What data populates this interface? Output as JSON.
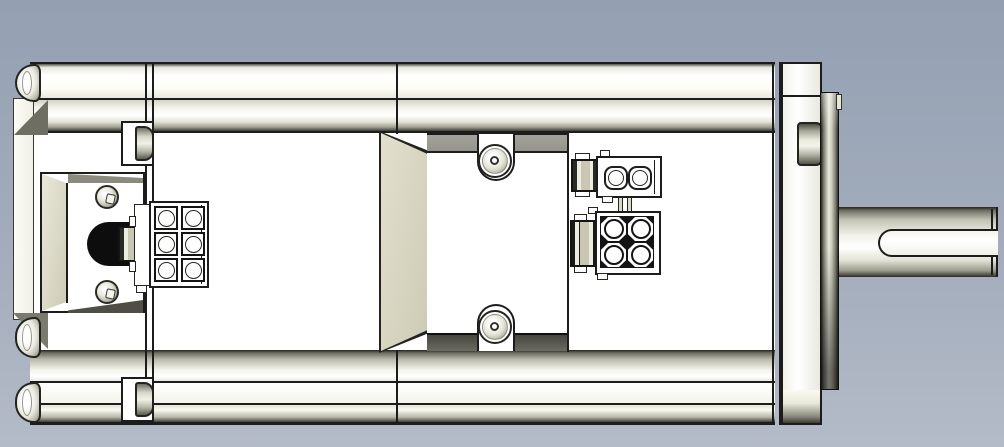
{
  "app": {
    "description": "CAD shaded side view of a servo motor: finned housing with rear cable connector (6-pin), mid terminal cover with screw tabs, 2-pin and 4-pin front connectors, mounting flange and keyed output shaft"
  },
  "colors": {
    "bg_top": "#94a0b2",
    "bg_bottom": "#b4bbc8",
    "outline": "#1c1c1c",
    "body_white": "#ffffff",
    "metal_light": "#f4f4ec",
    "metal_dark": "#55554b",
    "tan_face": "#d8d5c0",
    "recess_gray": "#9b9b93",
    "grommet_black": "#0d0d0d",
    "flange_dark": "#3a3a33"
  },
  "parts": {
    "viewport": "cad-viewport",
    "body": "motor-housing",
    "rear_cap": "rear-end-cap",
    "rear_connector": "6-pin-connector",
    "grommet": "cable-grommet",
    "terminal_cover": "terminal-cover",
    "signal_connector": "2-pin-connector",
    "power_connector": "4-pin-connector",
    "front_cap": "front-end-cap",
    "flange": "mounting-flange",
    "shaft": "output-shaft-with-keyway"
  }
}
